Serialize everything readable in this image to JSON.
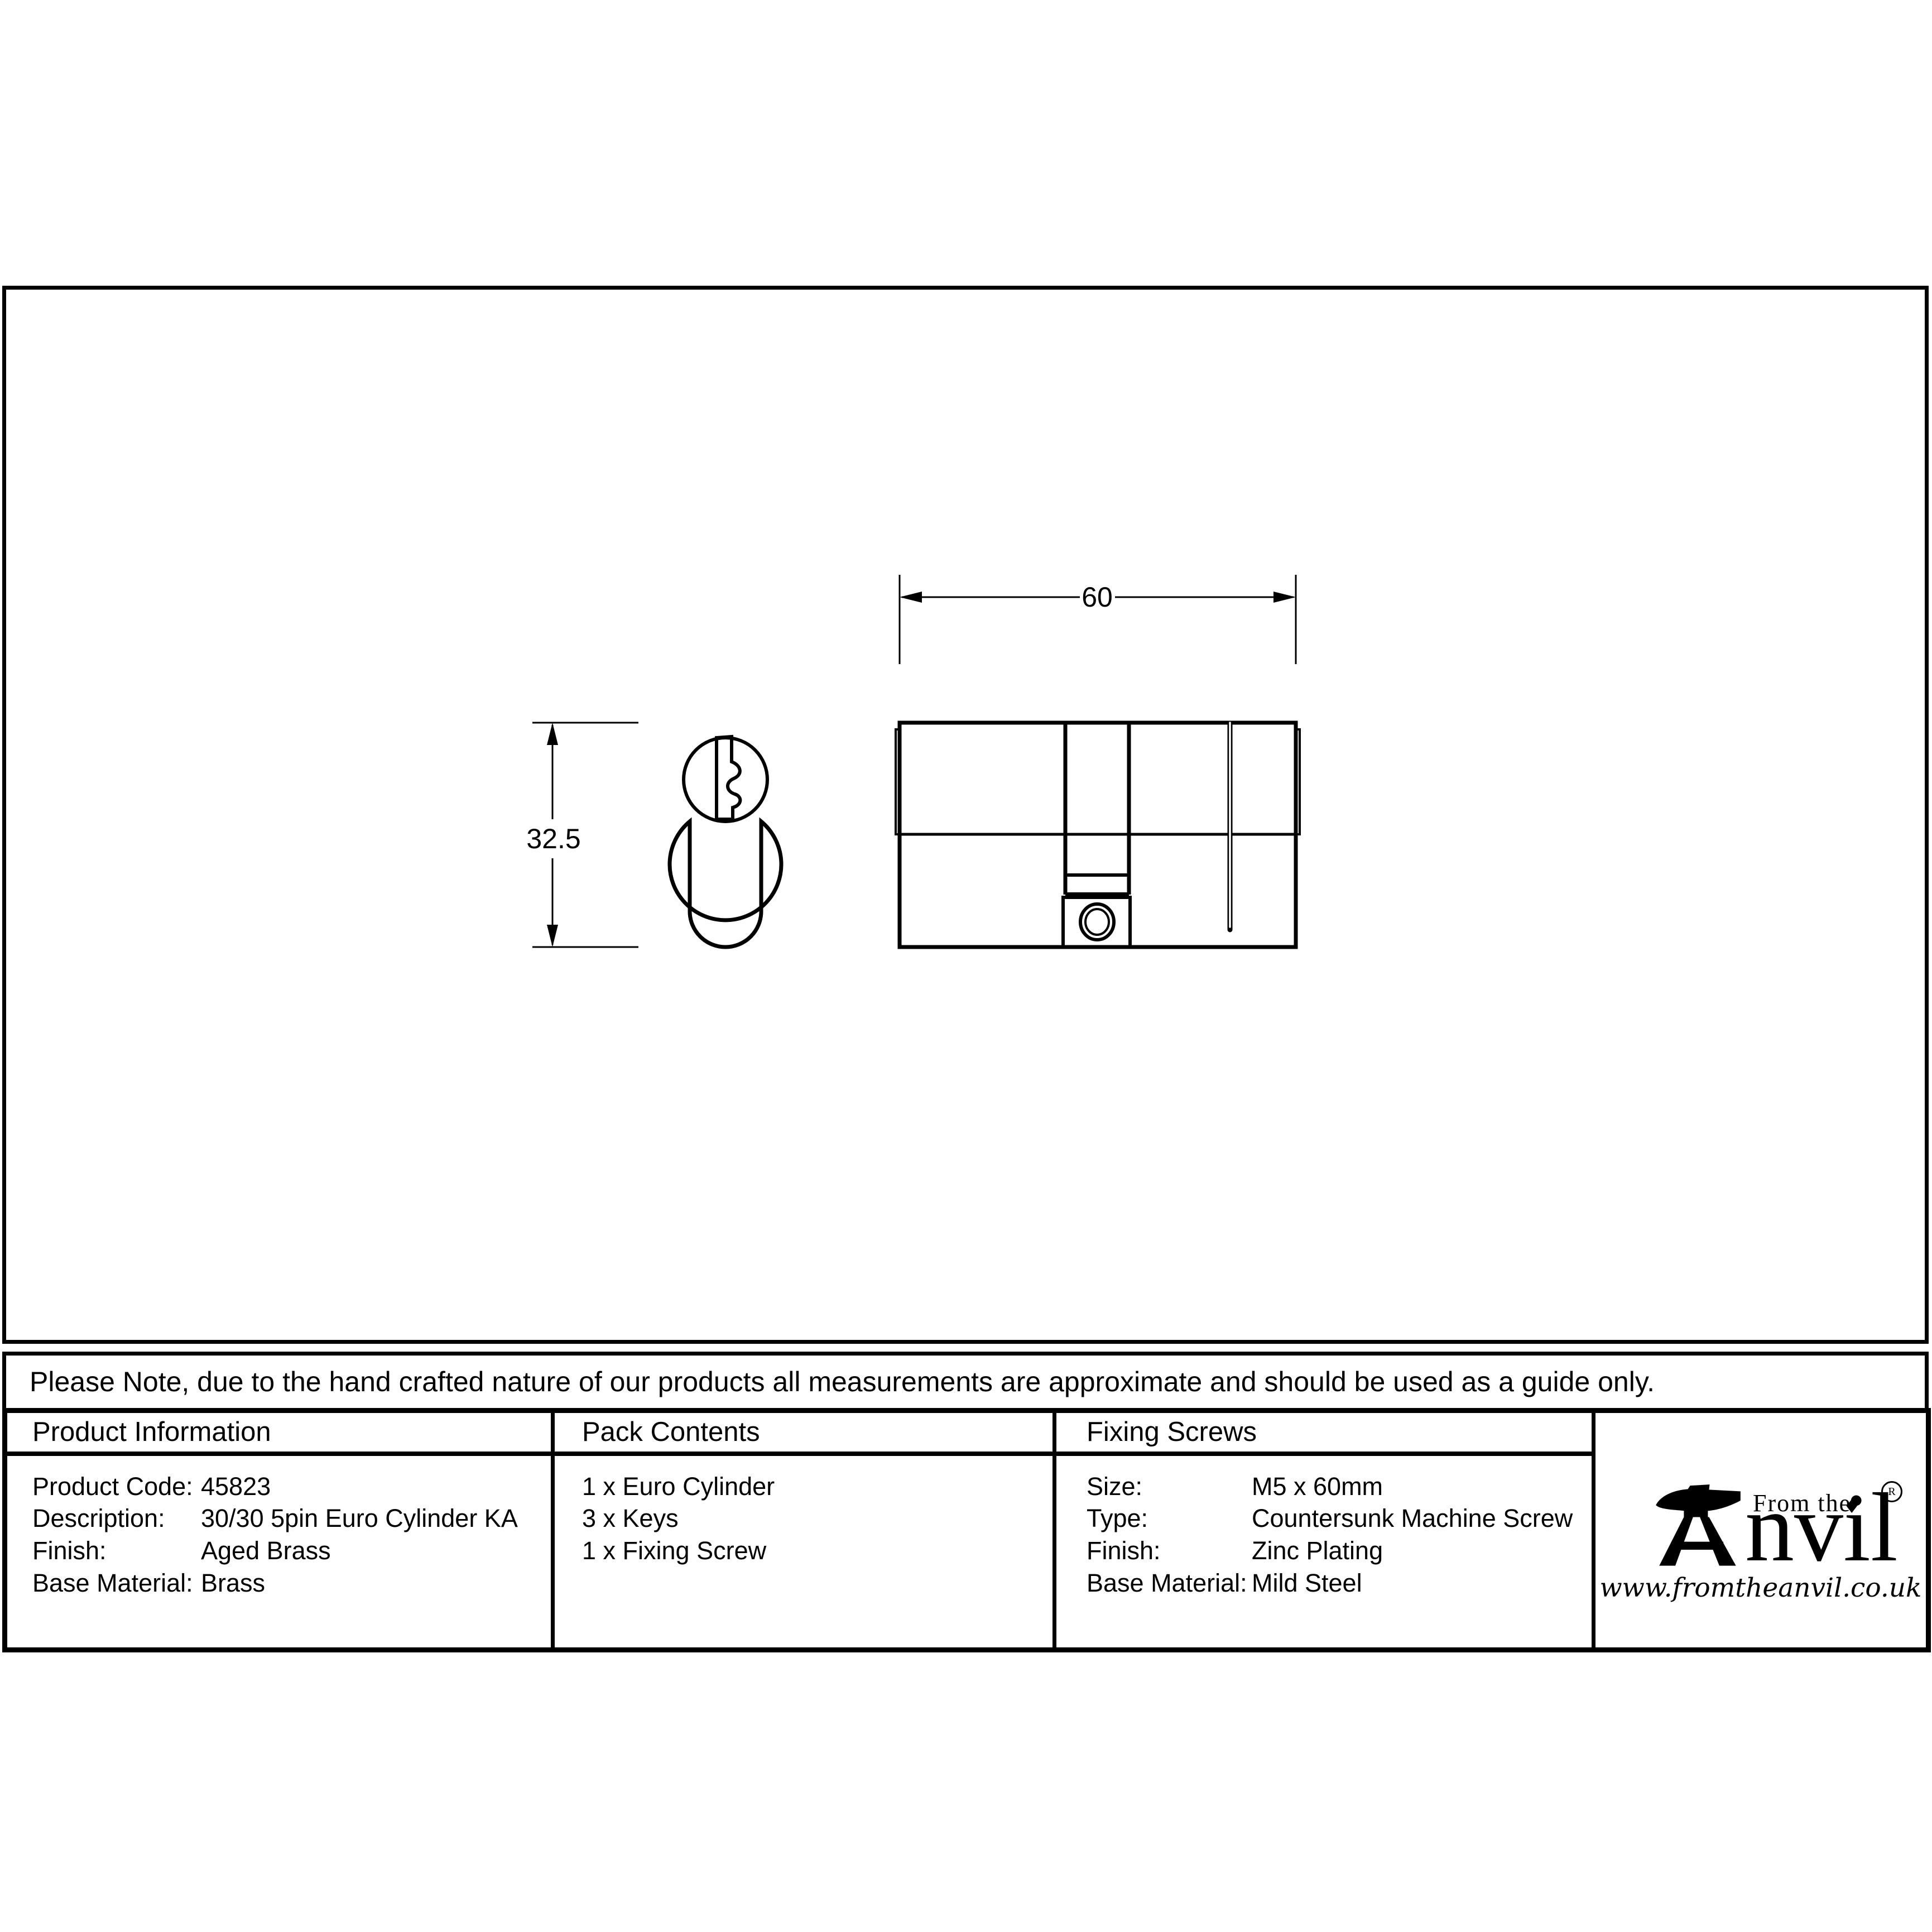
{
  "note": {
    "text": "Please Note, due to the hand crafted nature of our products all measurements are approximate and should be used as a guide only."
  },
  "drawing": {
    "views": [
      "euro-cylinder-front-view",
      "euro-cylinder-side-view"
    ],
    "dim_length_label": "60",
    "dim_height_label": "32.5"
  },
  "table": {
    "product_info": {
      "header": "Product Information",
      "rows": [
        {
          "label": "Product Code:",
          "value": "45823"
        },
        {
          "label": "Description:",
          "value": "30/30 5pin Euro Cylinder KA"
        },
        {
          "label": "Finish:",
          "value": "Aged Brass"
        },
        {
          "label": "Base Material:",
          "value": "Brass"
        }
      ]
    },
    "pack_contents": {
      "header": "Pack Contents",
      "items": [
        "1 x Euro Cylinder",
        "3 x Keys",
        "1 x Fixing Screw"
      ]
    },
    "fixing_screws": {
      "header": "Fixing Screws",
      "rows": [
        {
          "label": "Size:",
          "value": "M5 x 60mm"
        },
        {
          "label": "Type:",
          "value": "Countersunk Machine Screw"
        },
        {
          "label": "Finish:",
          "value": "Zinc Plating"
        },
        {
          "label": "Base Material:",
          "value": "Mild Steel"
        }
      ]
    }
  },
  "logo": {
    "tagline": "From the",
    "diamond": "♦",
    "brand_suffix": "nvil",
    "registered": "R",
    "url": "www.fromtheanvil.co.uk"
  },
  "colors": {
    "ink": "#000000",
    "paper": "#ffffff"
  }
}
